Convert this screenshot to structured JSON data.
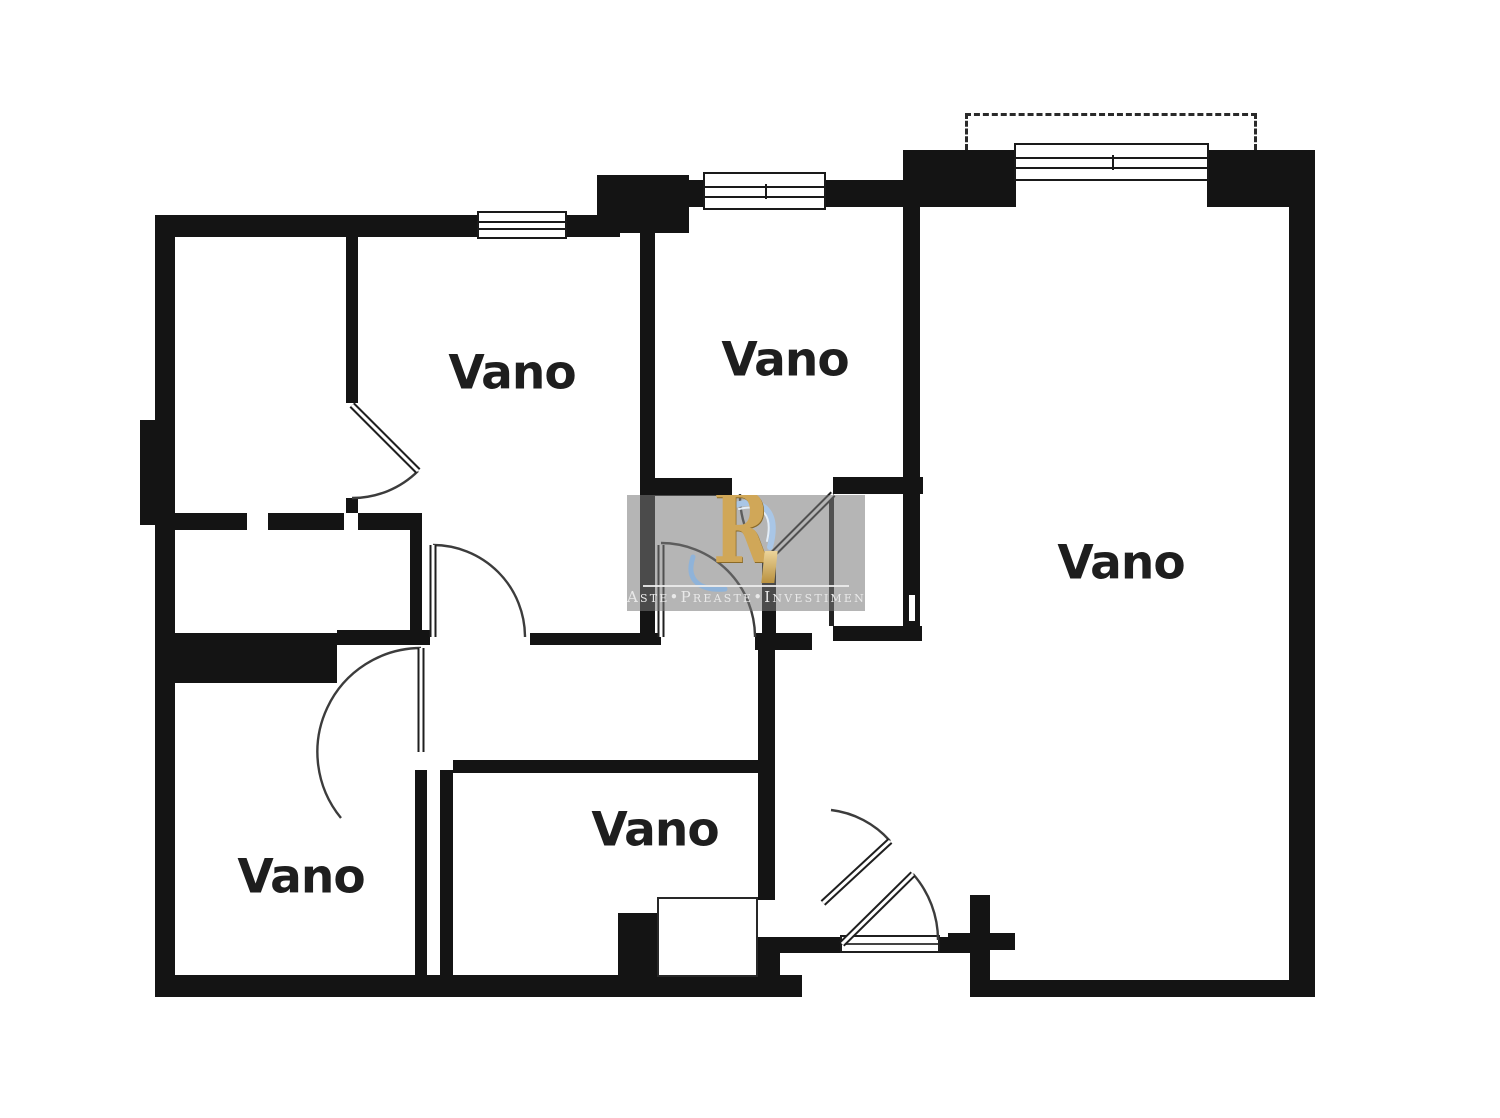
{
  "image_type": "architectural floor plan",
  "rooms": [
    {
      "label": "Vano"
    },
    {
      "label": "Vano"
    },
    {
      "label": "Vano"
    },
    {
      "label": "Vano"
    },
    {
      "label": "Vano"
    }
  ],
  "watermark": {
    "logo_letter": "R",
    "brand_text": "Aste•Preaste•Investimenti"
  },
  "colors": {
    "wall": "#141414",
    "background": "#ffffff",
    "door_arc": "#3c3c3c",
    "room_label": "#1e1e1e",
    "watermark_panel": "rgba(120,120,120,0.55)",
    "watermark_gold": "#d0a758",
    "watermark_blue": "#9bbcde",
    "watermark_text": "#e9e9e9"
  }
}
